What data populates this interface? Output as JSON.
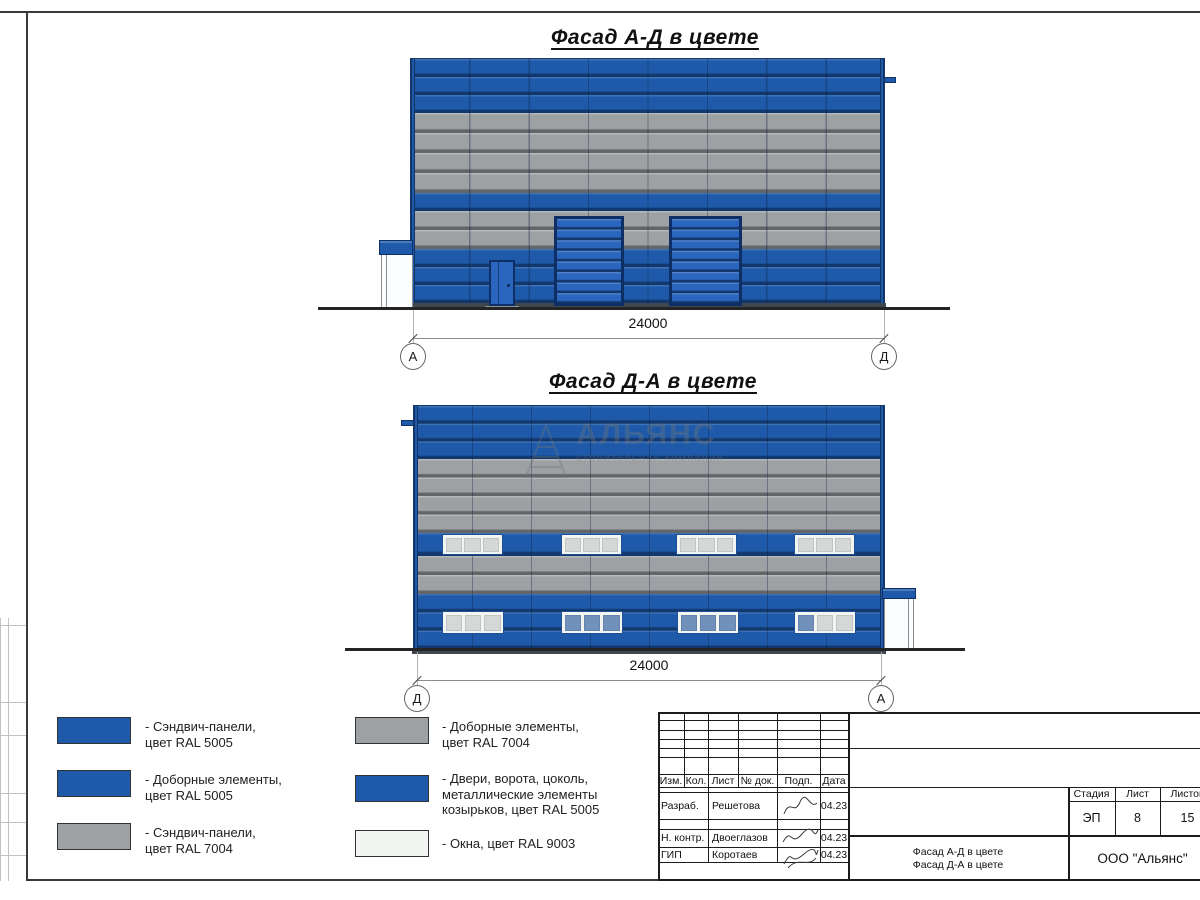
{
  "facade_top": {
    "title": "Фасад А-Д в цвете",
    "dimension": "24000",
    "axis_left": "А",
    "axis_right": "Д"
  },
  "facade_bottom": {
    "title": "Фасад Д-А в цвете",
    "dimension": "24000",
    "axis_left": "Д",
    "axis_right": "А"
  },
  "watermark": {
    "name": "АЛЬЯНС",
    "subtitle": "строительная компания"
  },
  "legend": {
    "items": [
      {
        "swatch": "blue",
        "label": "- Сэндвич-панели,\nцвет RAL 5005"
      },
      {
        "swatch": "blue",
        "label": "- Доборные элементы,\nцвет RAL 5005"
      },
      {
        "swatch": "gray",
        "label": "- Сэндвич-панели,\nцвет RAL 7004"
      },
      {
        "swatch": "gray",
        "label": "- Доборные элементы,\nцвет RAL 7004"
      },
      {
        "swatch": "blue",
        "label": "- Двери, ворота, цоколь,\nметаллические элементы\nкозырьков, цвет RAL 5005"
      },
      {
        "swatch": "white",
        "label": "- Окна, цвет RAL 9003"
      }
    ]
  },
  "title_block": {
    "columns": [
      "Изм.",
      "Кол.",
      "Лист",
      "№ док.",
      "Подп.",
      "Дата"
    ],
    "rows": [
      {
        "role": "Разраб.",
        "name": "Решетова",
        "date": "04.23"
      },
      {
        "role": "Н. контр.",
        "name": "Двоеглазов",
        "date": "04.23"
      },
      {
        "role": "ГИП",
        "name": "Коротаев",
        "date": "04.23"
      }
    ],
    "stage_label": "Стадия",
    "sheet_label": "Лист",
    "sheets_label": "Листов",
    "stage": "ЭП",
    "sheet": "8",
    "sheets": "15",
    "doc_title_line1": "Фасад А-Д в цвете",
    "doc_title_line2": "Фасад Д-А в цвете",
    "company": "ООО \"Альянс\""
  },
  "colors": {
    "c-blue": "#1e5aa9",
    "c-gray": "#9ea1a3",
    "c-gate": "#2a66bd",
    "c-navy": "#0d2f66",
    "c-win": "#f2f5f2",
    "c-plinth": "#41474e"
  }
}
